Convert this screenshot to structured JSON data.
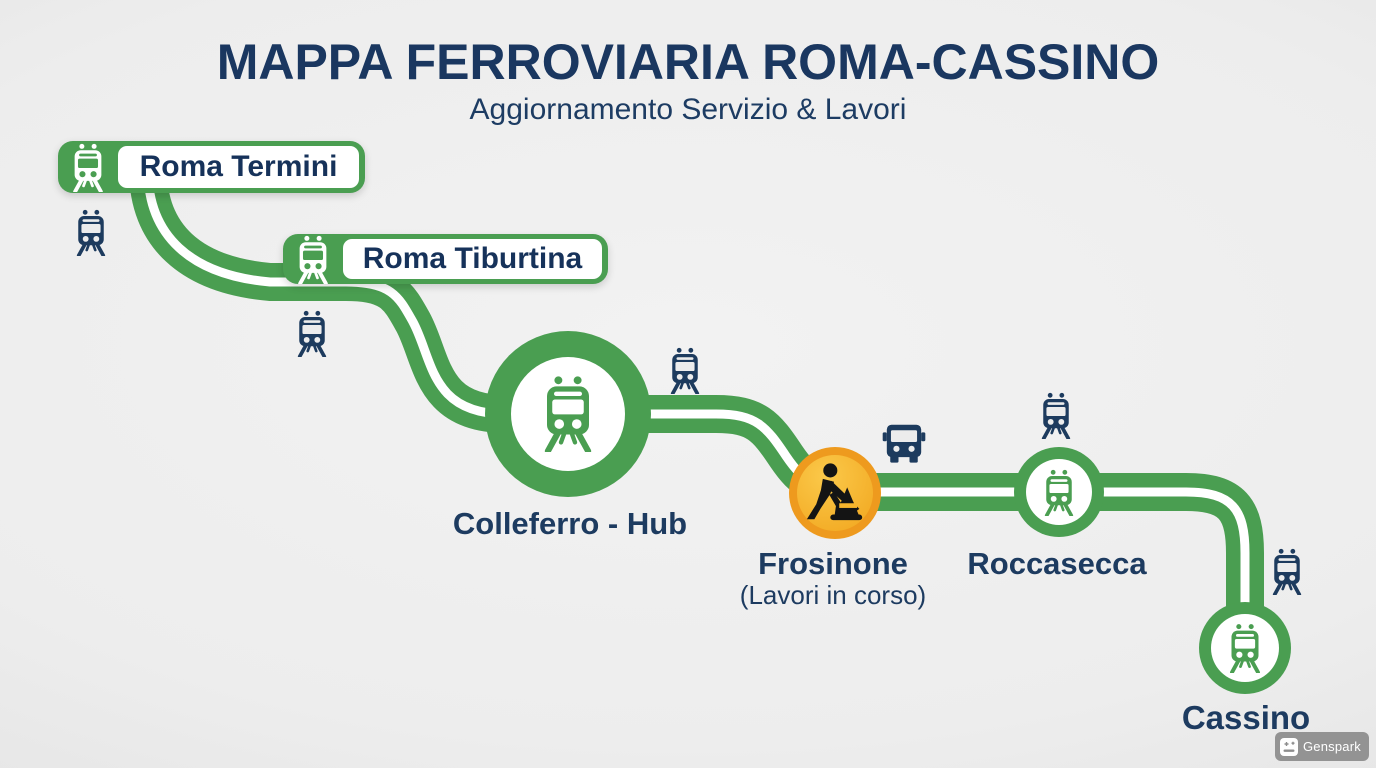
{
  "title": "MAPPA FERROVIARIA ROMA-CASSINO",
  "subtitle": "Aggiornamento Servizio & Lavori",
  "stations": [
    {
      "name": "Roma Termini",
      "type": "badge-station",
      "marker": "train-badge"
    },
    {
      "name": "Roma Tiburtina",
      "type": "badge-station",
      "marker": "train-badge"
    },
    {
      "name": "Colleferro - Hub",
      "type": "hub",
      "marker": "large-green-circle-train"
    },
    {
      "name": "Frosinone",
      "note": "(Lavori in corso)",
      "type": "works",
      "marker": "orange-roadworks-circle"
    },
    {
      "name": "Roccasecca",
      "type": "stop",
      "marker": "green-circle-train"
    },
    {
      "name": "Cassino",
      "type": "terminus",
      "marker": "green-circle-train"
    }
  ],
  "icons": {
    "train": "train-front-icon",
    "bus": "bus-front-icon",
    "worker": "roadworks-digger-icon",
    "watermark": "genspark-card-icon"
  },
  "colors": {
    "route_green": "#4a9e51",
    "navy": "#1d3b60",
    "works_ring_orange": "#ee9a1e",
    "works_fill_amber": "#f6b42c",
    "background": "#ececec"
  },
  "watermark": {
    "label": "Genspark"
  }
}
